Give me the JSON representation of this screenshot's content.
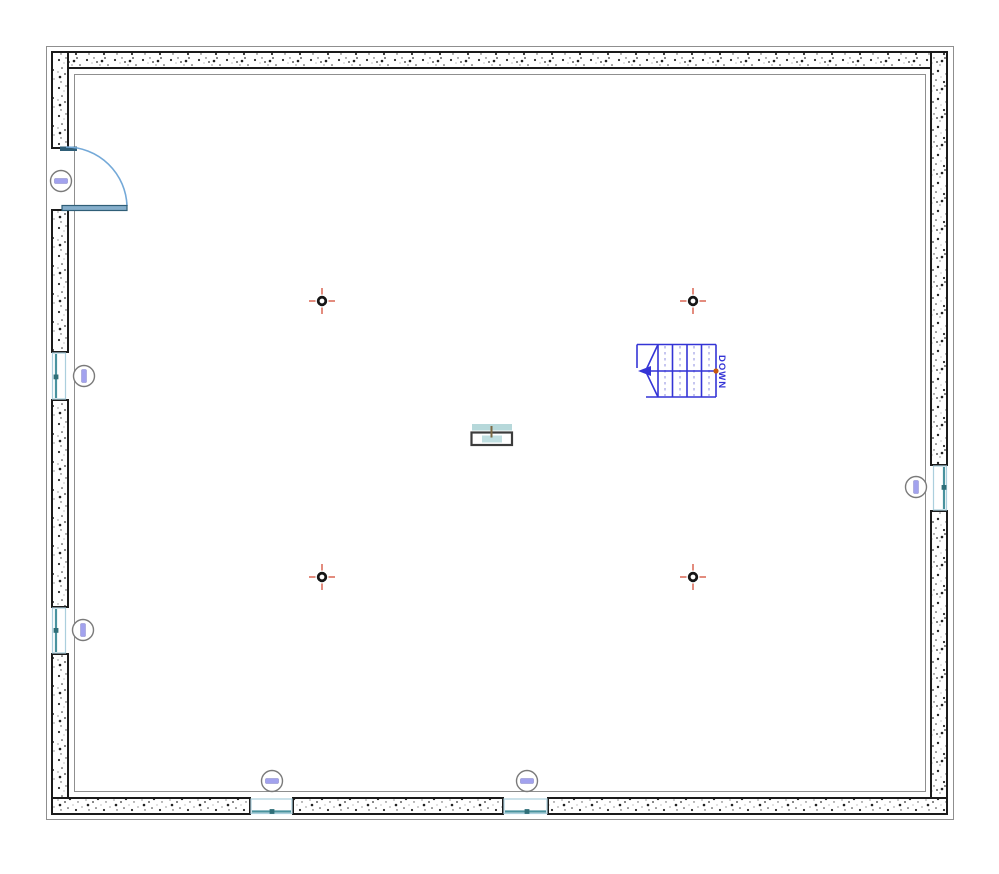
{
  "plan": {
    "stair": {
      "label": "DOWN"
    },
    "colors": {
      "wall_edge": "#1b1b1b",
      "thin_line": "#8f8f8f",
      "stair_blue": "#3434d6",
      "stair_dash": "#8e8ee0",
      "path_dot_orange": "#c85a10",
      "marker_ring": "#161616",
      "marker_tick_red": "#e08070",
      "tag_ring_gray": "#7a7a7a",
      "tag_bar_lavender": "#a2a2ee",
      "window_teal": "#49929e",
      "window_pane_dot": "#2f6e78",
      "window_frame_pale": "#abcfdd",
      "door_panel_fill": "#85aecb",
      "door_panel_edge": "#2f5e77",
      "door_arc": "#74a9d8",
      "sink_counter_teal": "#b6d8da",
      "sink_outline": "#3c3c3c",
      "sink_inner_teal": "#c0dfe1",
      "sink_tap_olive": "#7d6a45"
    },
    "icons": {
      "column_marker": "crosshair",
      "wall_tag": "circled-bar",
      "stair_direction": "arrow-left",
      "door_swing": "quarter-arc"
    }
  }
}
